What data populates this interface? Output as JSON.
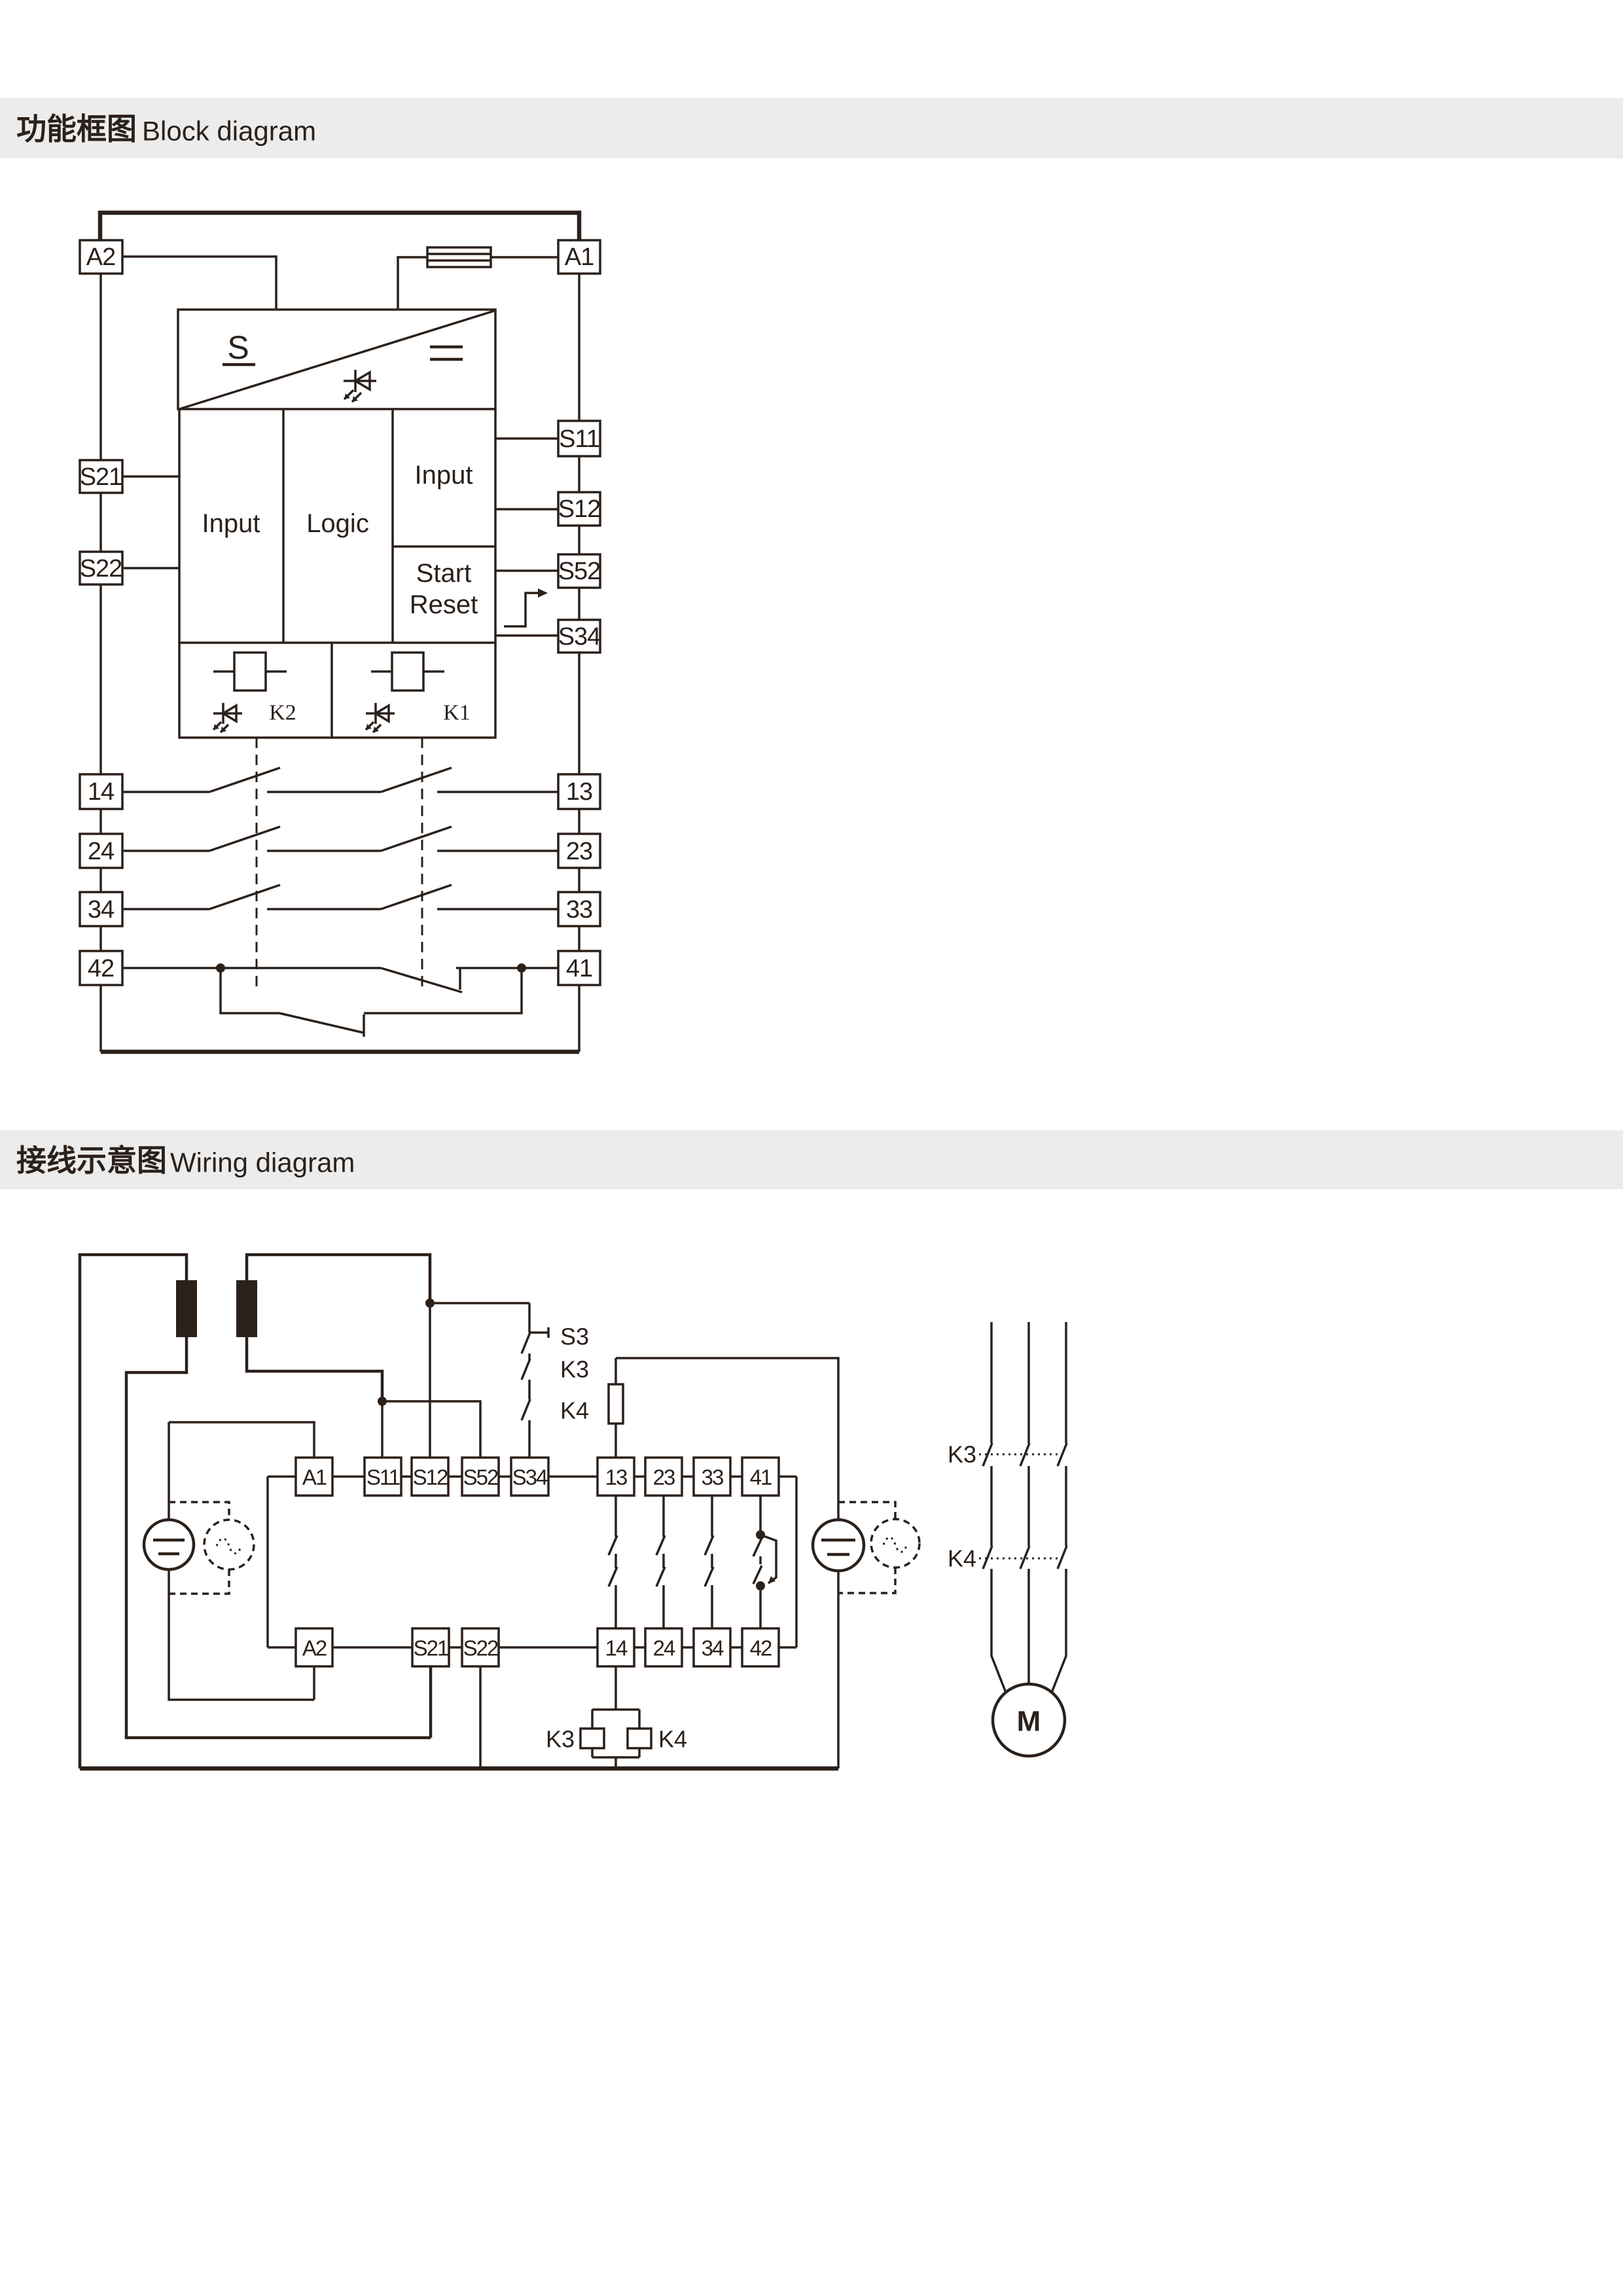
{
  "colors": {
    "ink": "#2b211b",
    "band_bg": "#ececec",
    "paper": "#ffffff"
  },
  "header_block": {
    "title_zh": "功能框图",
    "title_en": "Block diagram"
  },
  "header_wiring": {
    "title_zh": "接线示意图",
    "title_en": "Wiring diagram"
  },
  "block_diagram": {
    "left_terminals": [
      "A2",
      "S21",
      "S22",
      "14",
      "24",
      "34",
      "42"
    ],
    "right_terminals": [
      "A1",
      "S11",
      "S12",
      "S52",
      "S34",
      "13",
      "23",
      "33",
      "41"
    ],
    "power_label": "S",
    "input_left": "Input",
    "logic": "Logic",
    "input_right": "Input",
    "start": "Start",
    "reset": "Reset",
    "relay_k2": "K2",
    "relay_k1": "K1"
  },
  "wiring_diagram": {
    "top_terminals": [
      "A1",
      "S11",
      "S12",
      "S52",
      "S34",
      "13",
      "23",
      "33",
      "41"
    ],
    "bottom_terminals": [
      "A2",
      "S21",
      "S22",
      "14",
      "24",
      "34",
      "42"
    ],
    "stop_button": "S3",
    "chain_k3": "K3",
    "chain_k4": "K4",
    "coil_k3": "K3",
    "coil_k4": "K4",
    "contactor_k3": "K3",
    "contactor_k4": "K4",
    "motor": "M"
  }
}
